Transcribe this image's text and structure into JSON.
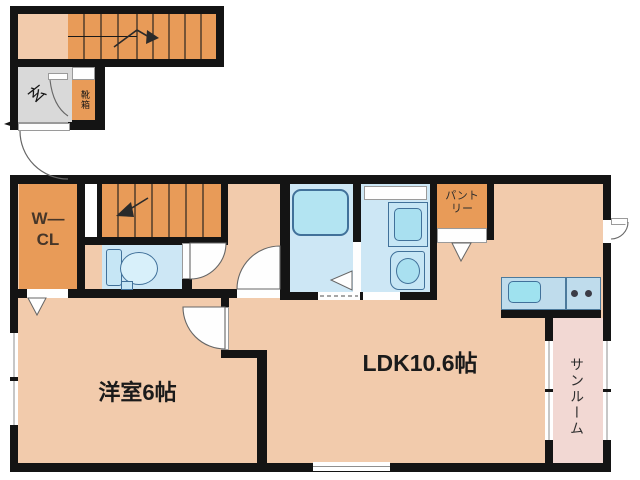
{
  "plan": {
    "first_floor": {
      "entrance_label": "玄",
      "shoe_box_label": "靴箱"
    },
    "second_floor": {
      "wcl_label_line1": "W—",
      "wcl_label_line2": "CL",
      "pantry_label_line1": "パント",
      "pantry_label_line2": "リー",
      "ldk_label": "LDK10.6帖",
      "western_room_label": "洋室6帖",
      "sunroom_label": "サンルーム"
    },
    "areas": {
      "ldk_tatami": "10.6",
      "western_room_tatami": "6"
    },
    "colors": {
      "wall": "#141414",
      "floor_main": "#F2CBAC",
      "wood_orange": "#E89B58",
      "wet_room_blue": "#CDE7F5",
      "fixture_blue": "#A9E0F0",
      "kitchen_counter": "#BFDCEC",
      "sunroom_pink": "#F2D8D3",
      "entrance_gray": "#D9D9D9"
    }
  }
}
